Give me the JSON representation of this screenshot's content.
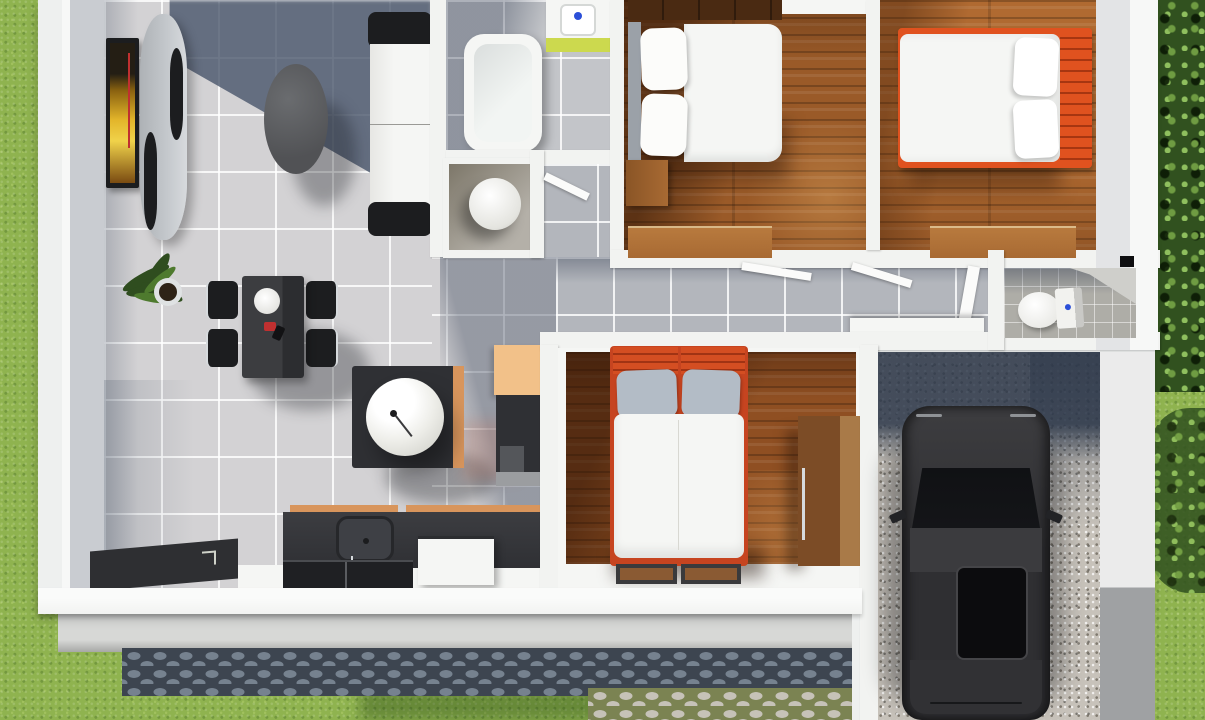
{
  "scene": {
    "type": "3d-floor-plan-top-view-render",
    "description": "Photorealistic top-down 3D render of a small single-storey house: open living/dining/kitchen with gray tile, bathroom with tub and round fixture closet, three wood-floor bedrooms, hallway, second toilet room, and a gravel carport with a dark parked car, surrounded by grass, trees and cobblestone paths",
    "style": "architectural visualization, afternoon sun casting blue-gray shadows"
  },
  "palette": {
    "grass": "#8fb34f",
    "grassDark": "#6e9440",
    "treeDark": "#31511f",
    "treeLeaf": "#6f9c42",
    "slab": "#eef0ef",
    "wall": "#f2f3f1",
    "wallFace": "#c9ccd1",
    "wallShade": "#e3e4e6",
    "tile": "#d3d2d4",
    "tileBath": "#c3c5c9",
    "tileHall": "#b3b6bc",
    "grout": "#ffffffd0",
    "shadowSlate": "#48556acc",
    "wood1": "#9a5a28",
    "wood2": "#b06a31",
    "wood3": "#8f4f22",
    "woodShelf": "#4a2a12",
    "furnWood": "#a86a33",
    "furnWoodLight": "#b87a3e",
    "bedOrange": "#e0521f",
    "bedRed": "#c64420",
    "pillowGray": "#b3bcc6",
    "whiteSoft": "#f5f6f4",
    "dark": "#2f3034",
    "darker": "#1c1d1f",
    "accentTan": "#f2c189",
    "accentOrange": "#d8955c",
    "vanityGreen": "#ccd94e",
    "faucetBlue": "#2b4fd8",
    "gravel": "#c7c2ba",
    "cobbleBase": "#3d4550",
    "cobbleStone": "#76828f",
    "cobbleLightBase": "#7b8352",
    "cobbleLightStone": "#c6c2b8",
    "concrete": "#d7d8d6",
    "concreteDark": "#a7a8a6",
    "carBody": "#2f2f32",
    "carGlass": "#141518",
    "carRoof": "#3b3b3e",
    "silver": "#c3c7cb",
    "chrome": "#d6dadd",
    "artYellow": "#e3b52a",
    "artRed": "#c03030"
  },
  "rooms": [
    {
      "id": "living-room",
      "label": "Living room",
      "floor": "light gray tile"
    },
    {
      "id": "dining-area",
      "label": "Dining area",
      "floor": "light gray tile"
    },
    {
      "id": "kitchen",
      "label": "Kitchen",
      "floor": "light gray tile"
    },
    {
      "id": "bathroom",
      "label": "Bathroom",
      "floor": "gray tile"
    },
    {
      "id": "toilet-closet",
      "label": "Toilet closet",
      "floor": "gray tile"
    },
    {
      "id": "corridor",
      "label": "Corridor",
      "floor": "gray tile"
    },
    {
      "id": "hallway",
      "label": "Hallway",
      "floor": "gray tile"
    },
    {
      "id": "bedroom-1",
      "label": "Bedroom 1",
      "floor": "wood planks"
    },
    {
      "id": "bedroom-2",
      "label": "Bedroom 2",
      "floor": "wood planks"
    },
    {
      "id": "bedroom-3",
      "label": "Bedroom 3",
      "floor": "wood planks"
    },
    {
      "id": "toilet-room",
      "label": "Toilet room",
      "floor": "stone tile"
    },
    {
      "id": "carport",
      "label": "Carport",
      "floor": "gravel"
    },
    {
      "id": "yard",
      "label": "Yard",
      "floor": "grass"
    }
  ],
  "furniture": [
    {
      "room": "living-room",
      "items": [
        "wall tv with artwork",
        "curved tv console",
        "oval coffee table",
        "white sofa with black armrests",
        "potted plant"
      ]
    },
    {
      "room": "dining-area",
      "items": [
        "black dining table",
        "4 black chairs with chrome legs",
        "white plate",
        "red condiment set"
      ]
    },
    {
      "room": "kitchen",
      "items": [
        "dark island with round white basin",
        "tan wall counter",
        "tall dark cabinet",
        "counter with sink",
        "white appliance",
        "dark cooktop panel",
        "entry doormat"
      ]
    },
    {
      "room": "bathroom",
      "items": [
        "bathtub",
        "vanity sink with green cabinet"
      ]
    },
    {
      "room": "toilet-closet",
      "items": [
        "round white fixture"
      ]
    },
    {
      "room": "bedroom-1",
      "items": [
        "double bed white bedding",
        "gray headboard",
        "dark wood shelf",
        "nightstand",
        "wood dresser"
      ]
    },
    {
      "room": "bedroom-2",
      "items": [
        "bed with orange frame and headboard",
        "white bedding",
        "wood dresser"
      ]
    },
    {
      "room": "bedroom-3",
      "items": [
        "bed with red-orange headboard",
        "gray pillows",
        "white duvet",
        "wood wardrobe",
        "two brown doormats"
      ]
    },
    {
      "room": "toilet-room",
      "items": [
        "toilet with tank",
        "wall fixture"
      ]
    },
    {
      "room": "carport",
      "items": [
        "dark gray car with sunroof"
      ]
    },
    {
      "room": "yard",
      "items": [
        "lawn",
        "trees and bushes",
        "dark cobblestone path",
        "light cobblestone driveway",
        "concrete apron"
      ]
    }
  ]
}
